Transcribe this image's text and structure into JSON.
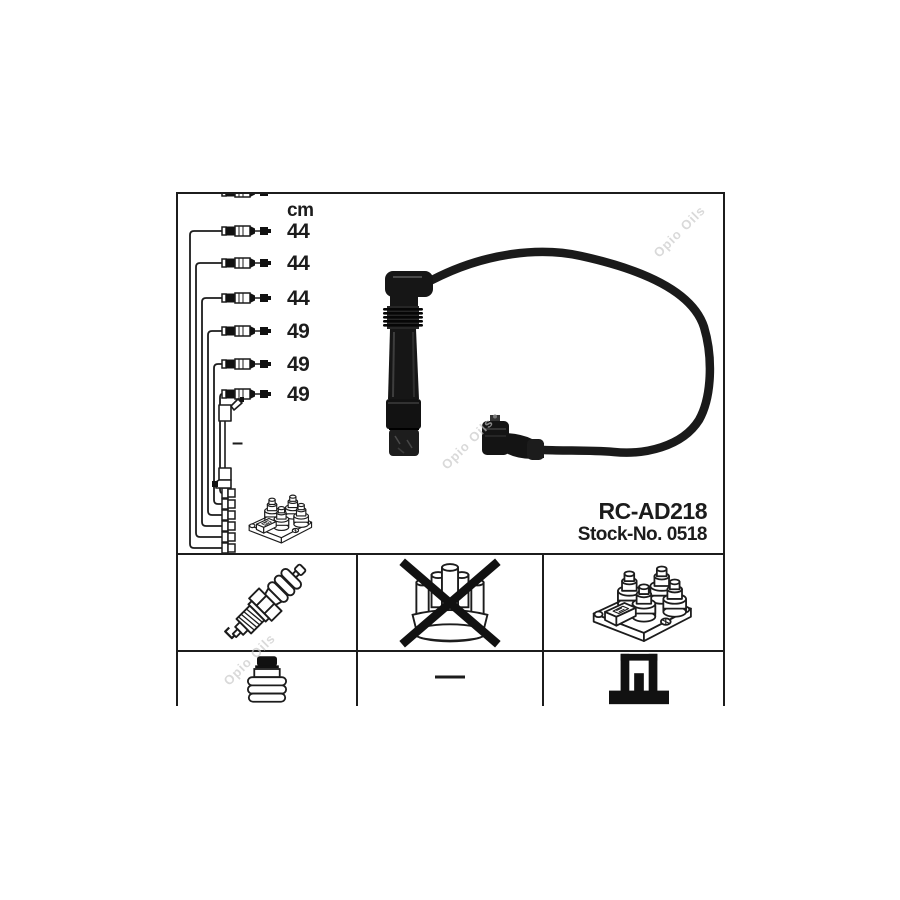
{
  "product": {
    "part_number": "RC-AD218",
    "stock_number": "Stock-No. 0518"
  },
  "measurements": {
    "unit": "cm",
    "cable_lengths": [
      "44",
      "44",
      "44",
      "49",
      "49",
      "49"
    ],
    "coil_lead_length": "–"
  },
  "legend": {
    "spark_plug": {
      "icon": "spark-plug-icon",
      "crossed": false
    },
    "distributor_cap": {
      "icon": "distributor-cap-icon",
      "crossed": true
    },
    "ignition_coil": {
      "icon": "ignition-coil-icon",
      "crossed": false
    },
    "terminal_nut": {
      "icon": "terminal-nut-icon",
      "crossed": false
    },
    "not_applicable": {
      "symbol": "—"
    },
    "connector_sleeve": {
      "icon": "connector-sleeve-icon",
      "crossed": false
    }
  },
  "watermark": {
    "text": "Opio Oils"
  },
  "colors": {
    "line": "#1c1c1c",
    "part_black": "#161616",
    "watermark": "#c6c6c6",
    "background": "#ffffff"
  }
}
